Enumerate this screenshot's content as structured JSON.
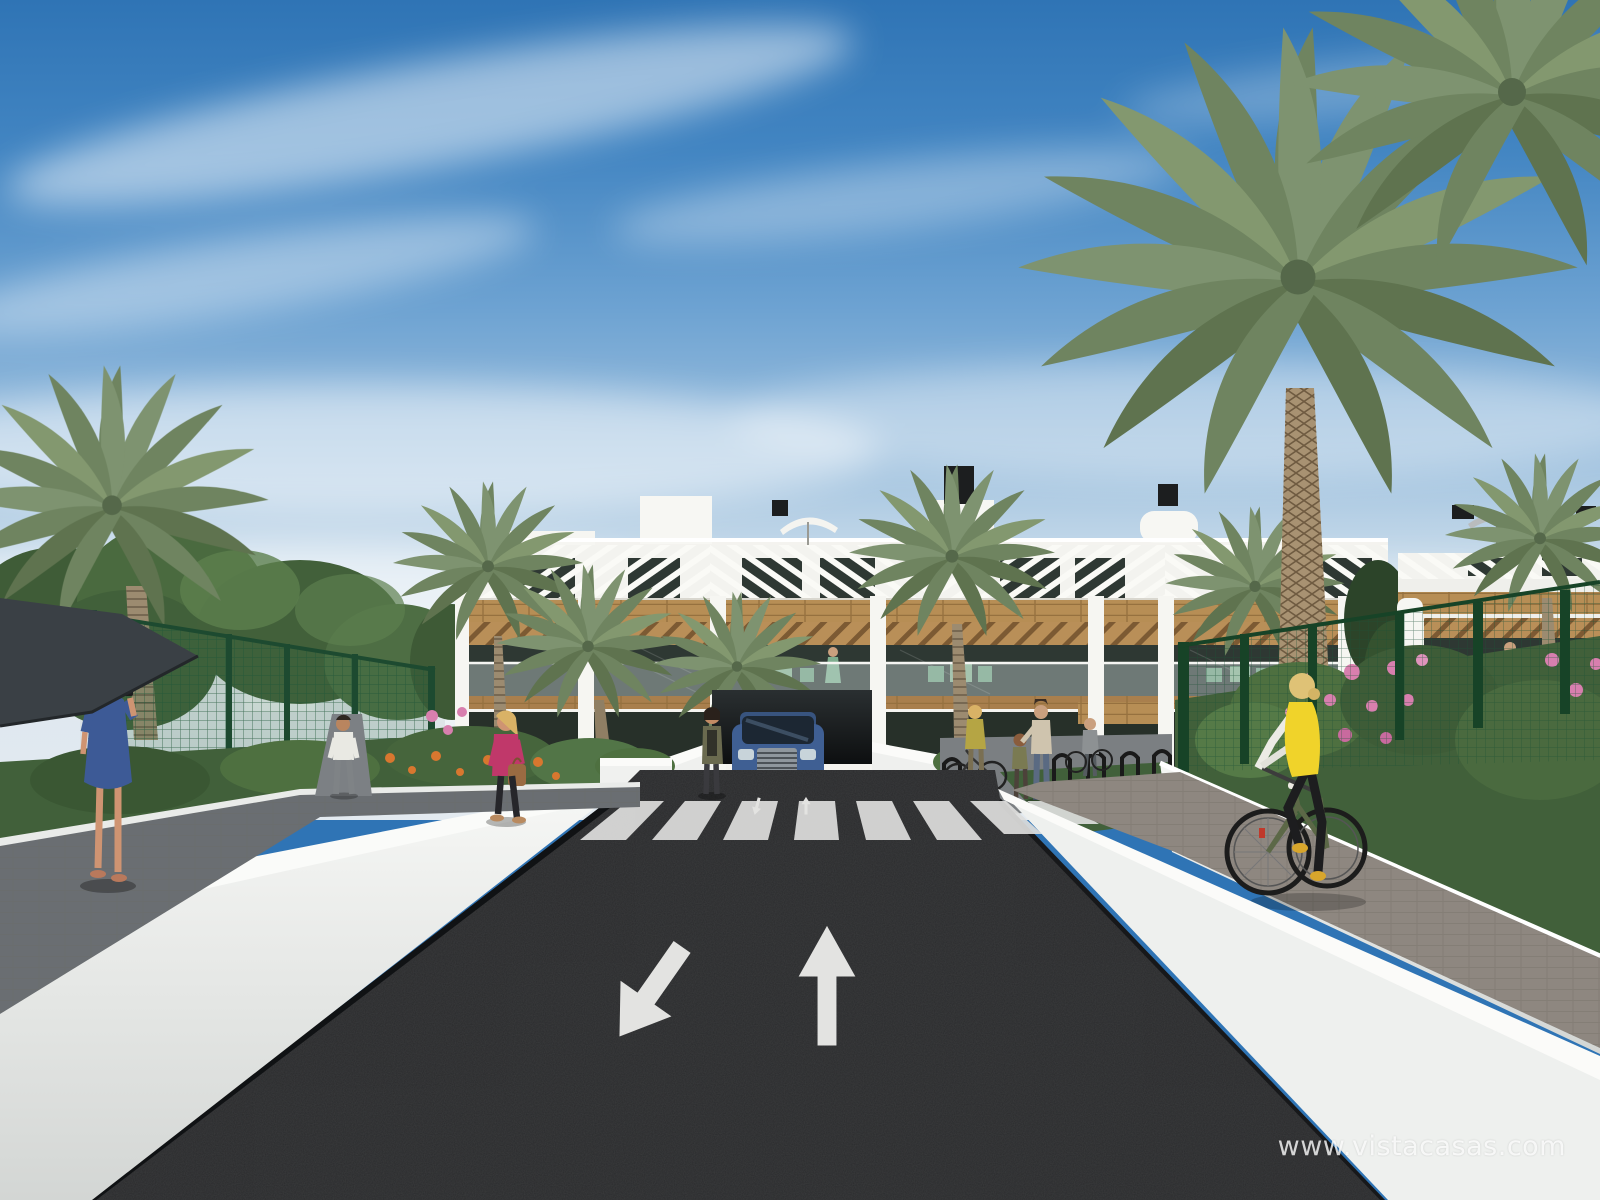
{
  "scene": {
    "type": "architectural-exterior-render",
    "setting": "New-build apartment complex street view with palm trees, pedestrians, cyclist and car at garage ramp",
    "watermark": {
      "text": "www.vistacasas.com"
    }
  },
  "road": {
    "crosswalk_stripe_count": 8,
    "lane_arrows": [
      "down-left",
      "up"
    ]
  },
  "colors": {
    "sky_top": "#2f74b5",
    "sky_horizon": "#dde7ef",
    "building_white": "#f4f3ef",
    "wood_accent": "#b78e55",
    "window_glass": "#2e3833",
    "asphalt": "#2a2b2d",
    "road_marking": "#e3e3e1",
    "wall_white": "#f1f2f0",
    "fence_green": "#235c3c",
    "palm_green": "#748861",
    "foliage_green": "#48663d",
    "car_blue": "#3f5f93",
    "vest_yellow": "#f0d32a",
    "dress_blue": "#3d5a96",
    "jacket_pink": "#c0386a",
    "flower_pink": "#d87fae",
    "flower_orange": "#d8772f"
  }
}
